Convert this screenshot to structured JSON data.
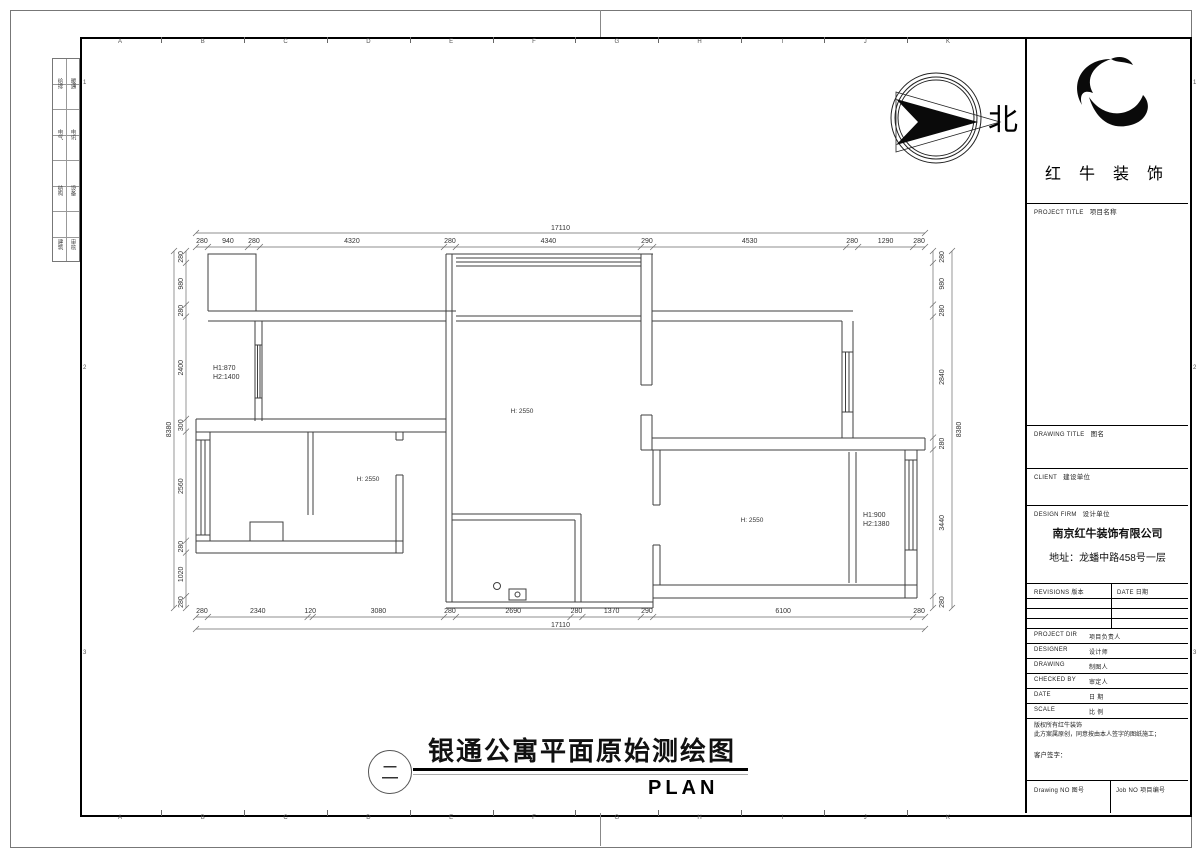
{
  "frame": {
    "grid_letters": [
      "A",
      "B",
      "C",
      "D",
      "E",
      "F",
      "G",
      "H",
      "I",
      "J",
      "K"
    ],
    "side_numbers": [
      "1",
      "2",
      "3"
    ]
  },
  "margin": {
    "disciplines": [
      {
        "left": "给排",
        "right": "暖通"
      },
      {
        "left": "电气",
        "right": "电讯"
      },
      {
        "left": "结构",
        "right": "设备"
      },
      {
        "left": "建筑",
        "right": "审核"
      }
    ]
  },
  "plan": {
    "dimensions": {
      "top": [
        280,
        940,
        280,
        4320,
        280,
        4340,
        290,
        4530,
        280,
        1290,
        280
      ],
      "top_total": "17110",
      "bottom": [
        280,
        2340,
        120,
        3080,
        280,
        2690,
        280,
        1370,
        290,
        6100,
        280
      ],
      "bottom_total": "17110",
      "left": [
        280,
        980,
        280,
        2400,
        300,
        2560,
        280,
        1020,
        280
      ],
      "left_total": "8380",
      "right": [
        280,
        980,
        280,
        2840,
        280,
        3440,
        280
      ],
      "right_total": "8380"
    },
    "labels": {
      "living_h": "H: 2550",
      "room2_h": "H: 2550",
      "right_room_h": "H: 2550",
      "left_window": {
        "line1": "H1:870",
        "line2": "H2:1400"
      },
      "right_window": {
        "line1": "H1:900",
        "line2": "H2:1380"
      }
    },
    "north_label": "北"
  },
  "bottom_title": {
    "circle_char": "二",
    "title": "银通公寓平面原始测绘图",
    "subtitle": "PLAN"
  },
  "title_block": {
    "logo_text": "红 牛 装 饰",
    "project_title_en": "PROJECT TITLE",
    "project_title_cn": "项目名称",
    "drawing_title_en": "DRAWING TITLE",
    "drawing_title_cn": "图名",
    "client_en": "CLIENT",
    "client_cn": "建设单位",
    "design_firm_en": "DESIGN FIRM",
    "design_firm_cn": "设计单位",
    "company": "南京红牛装饰有限公司",
    "address": "地址：龙蟠中路458号一层",
    "revisions_hdr": "REVISIONS 版本",
    "date_hdr": "DATE 日期",
    "staff": [
      {
        "en": "PROJECT DIR",
        "cn": "项目负责人"
      },
      {
        "en": "DESIGNER",
        "cn": "设计师"
      },
      {
        "en": "DRAWING",
        "cn": "制图人"
      },
      {
        "en": "CHECKED BY",
        "cn": "审定人"
      },
      {
        "en": "DATE",
        "cn": "日 期"
      },
      {
        "en": "SCALE",
        "cn": "比 例"
      }
    ],
    "notice_line1": "版权所有红牛装饰",
    "notice_line2": "此方案属原创，同意按由本人签字的图纸施工；",
    "signer": "客户签字：",
    "drawing_no": "Drawing NO 图号",
    "job_no": "Job NO 项目编号"
  }
}
